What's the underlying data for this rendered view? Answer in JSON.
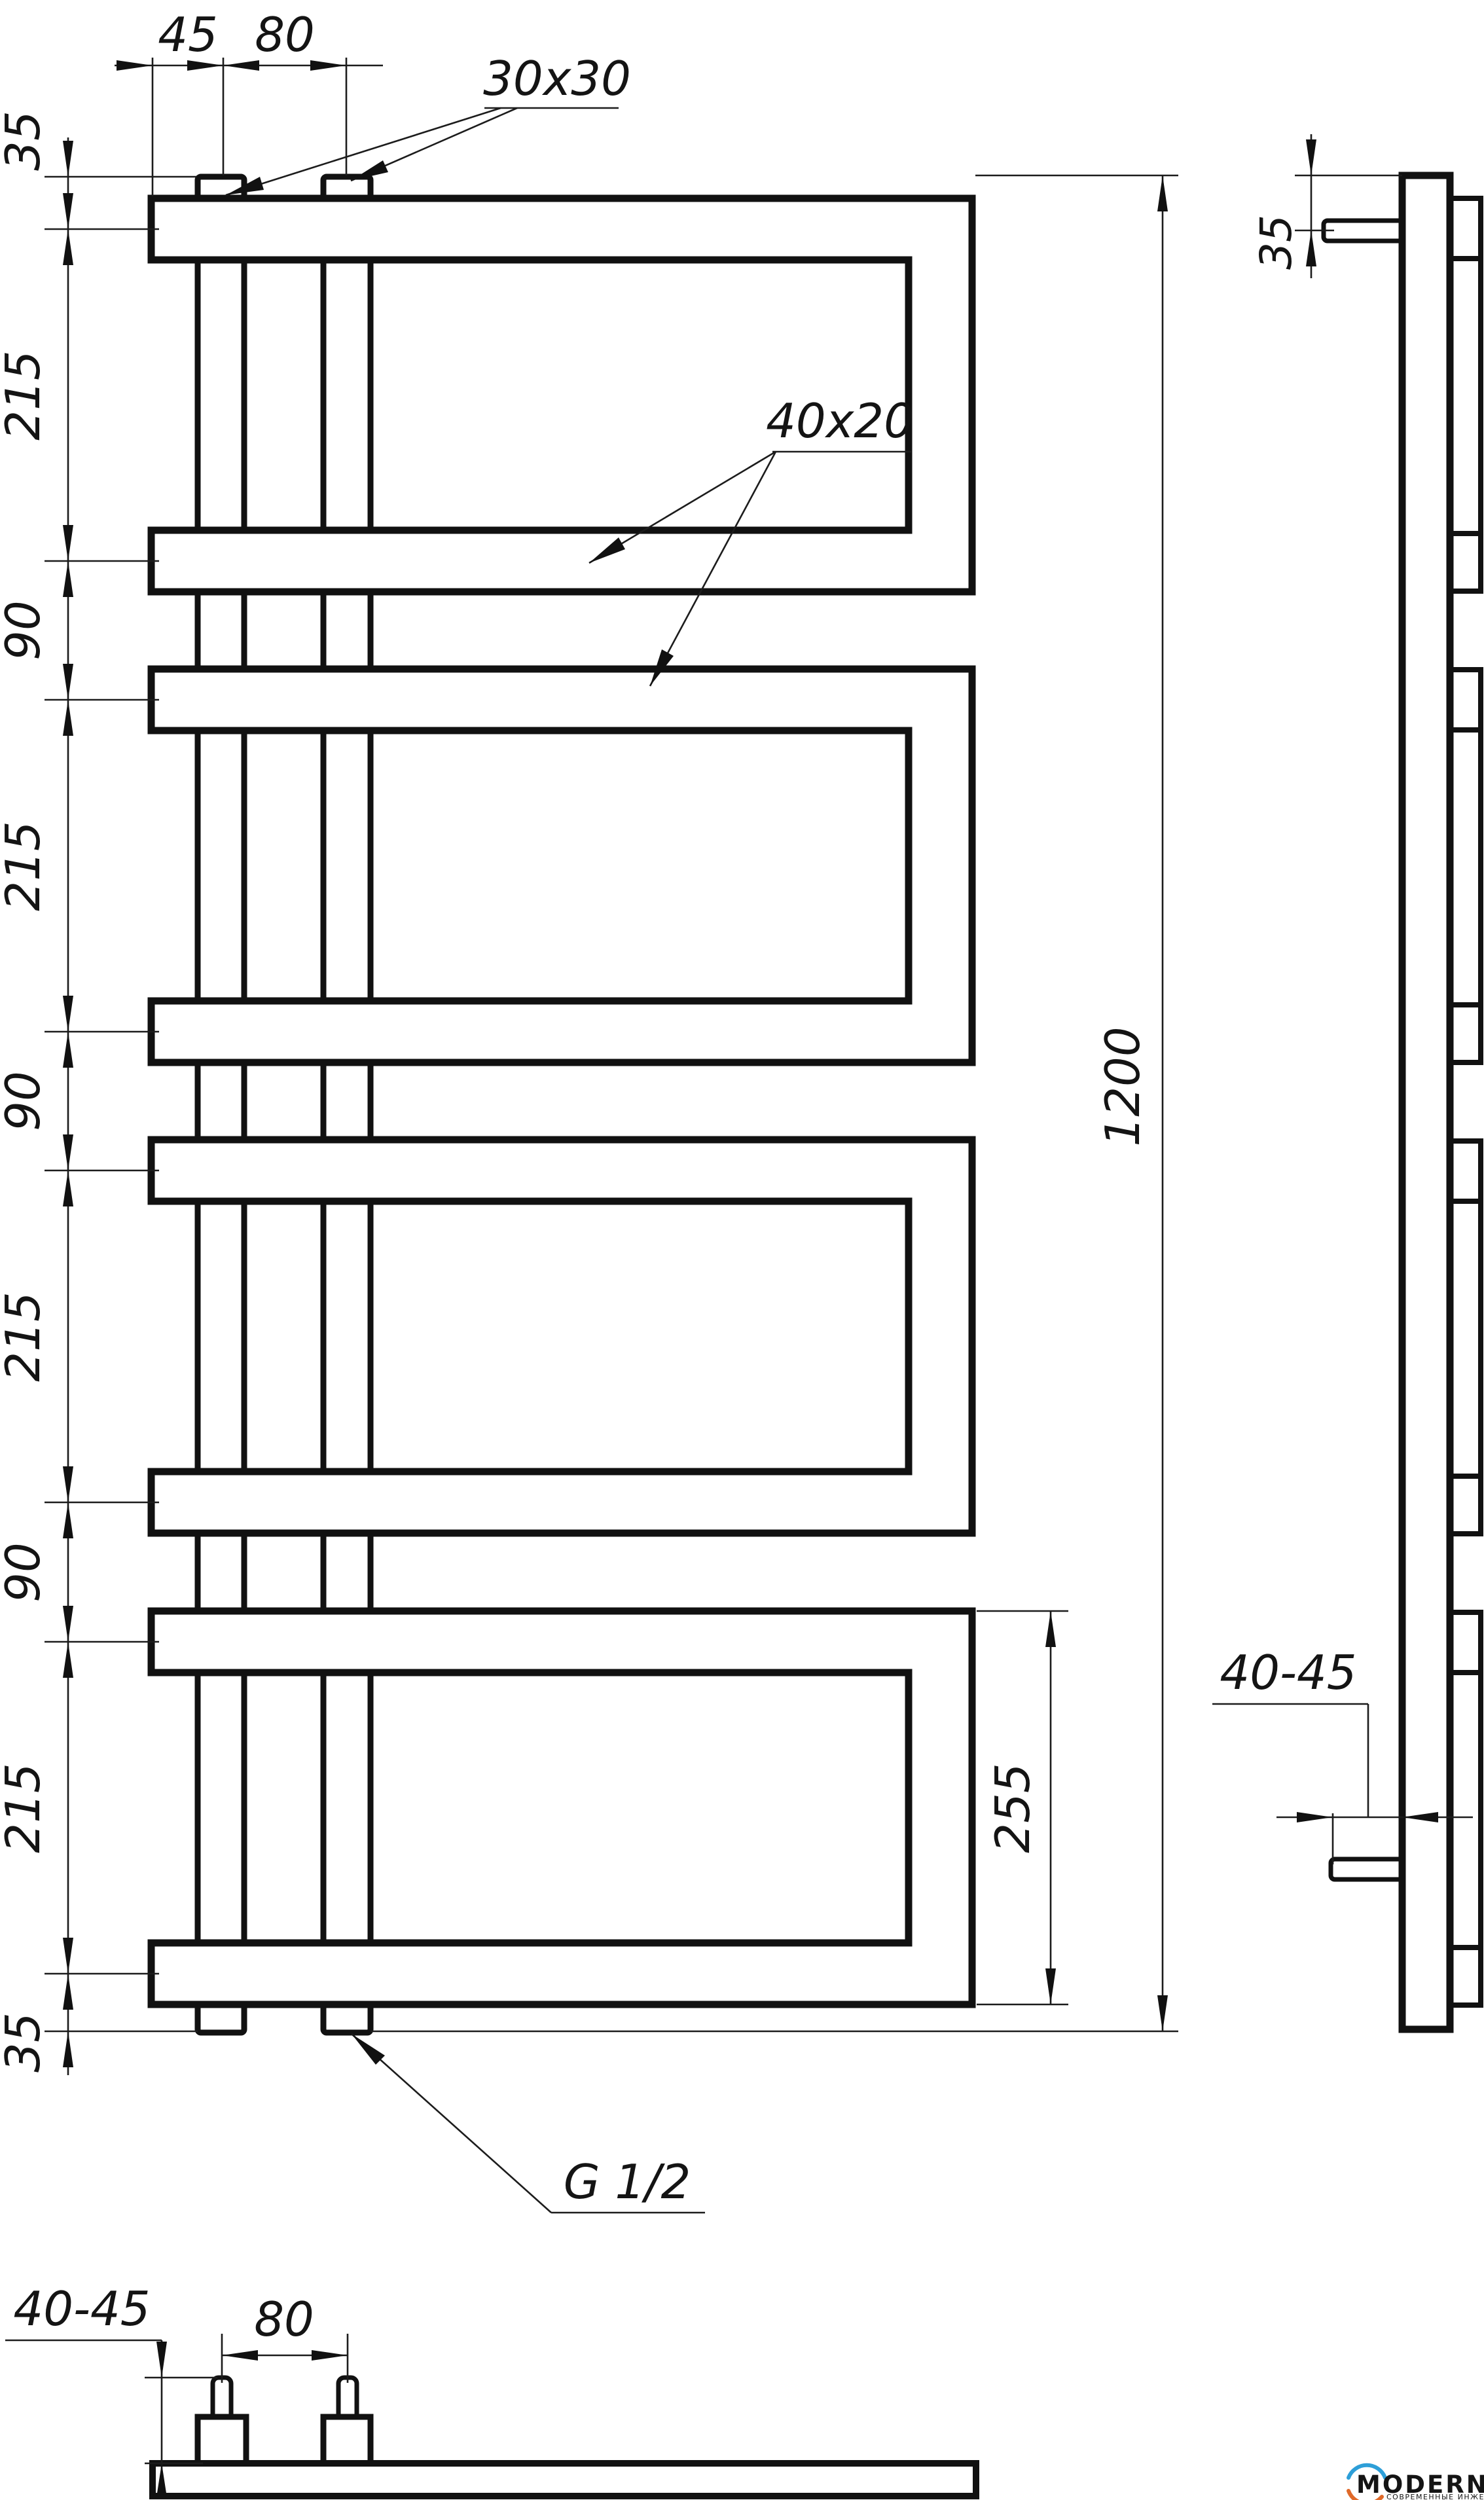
{
  "front_view": {
    "top_dims": {
      "offset_45": "45",
      "spacing_80": "80"
    },
    "profile_square": "30x30",
    "profile_flat": "40x20",
    "left_chain": [
      "35",
      "215",
      "90",
      "215",
      "90",
      "215",
      "90",
      "215",
      "35"
    ],
    "total_height": "1200",
    "bottom_loop_height": "255",
    "thread_label": "G 1/2"
  },
  "side_view": {
    "top_offset": "35",
    "wall_clearance": "40-45"
  },
  "bottom_view": {
    "pipe_spacing": "80",
    "wall_clearance": "40-45"
  },
  "logo": {
    "brand": "MODERNSYS",
    "tagline": "СОВРЕМЕННЫЕ ИНЖЕНЕРНЫЕ СИСТЕМЫ"
  }
}
